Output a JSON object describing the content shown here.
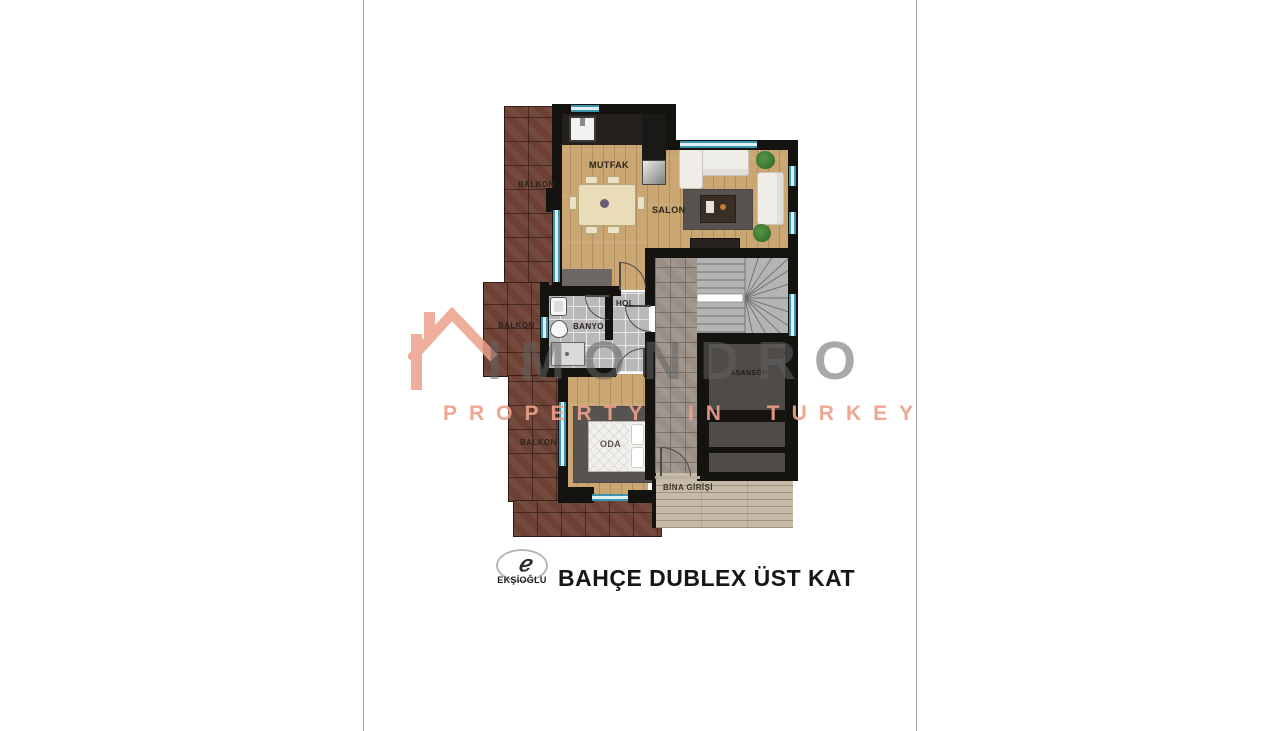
{
  "page": {
    "background": "#ffffff",
    "side_rule_color": "#a3a3a3"
  },
  "plan": {
    "rooms": {
      "balkon_top": {
        "label": "BALKON"
      },
      "balkon_mid": {
        "label": "BALKON"
      },
      "balkon_bottom": {
        "label": "BALKON"
      },
      "mutfak": {
        "label": "MUTFAK"
      },
      "salon": {
        "label": "SALON"
      },
      "hol": {
        "label": "HOL"
      },
      "banyo": {
        "label": "BANYO"
      },
      "oda": {
        "label": "ODA"
      },
      "asansor": {
        "label": "ASANSÖR"
      },
      "bina_girisi": {
        "label": "BİNA GİRİŞİ"
      }
    },
    "colors": {
      "wall": "#151310",
      "window_frame": "#3F93AD",
      "brick_balcony": "#6D4034",
      "wood_floor": "#C9A672",
      "bath_tile": "#B9B8BA",
      "stair_stone": "#998F86",
      "deck": "#C6BBA8",
      "elevator_shaft": "#4E4B48",
      "rug": "#565351"
    }
  },
  "watermark": {
    "brand": "IMONDRO",
    "tagline": "PROPERTY IN TURKEY",
    "accent_color": "#ED9F8B",
    "gray_color": "#8C8C8C",
    "house_icon": "roof-with-chimney"
  },
  "footer": {
    "logo_monogram": "ℯ",
    "logo_brand": "EKŞİOĞLU",
    "title": "BAHÇE DUBLEX ÜST KAT"
  }
}
